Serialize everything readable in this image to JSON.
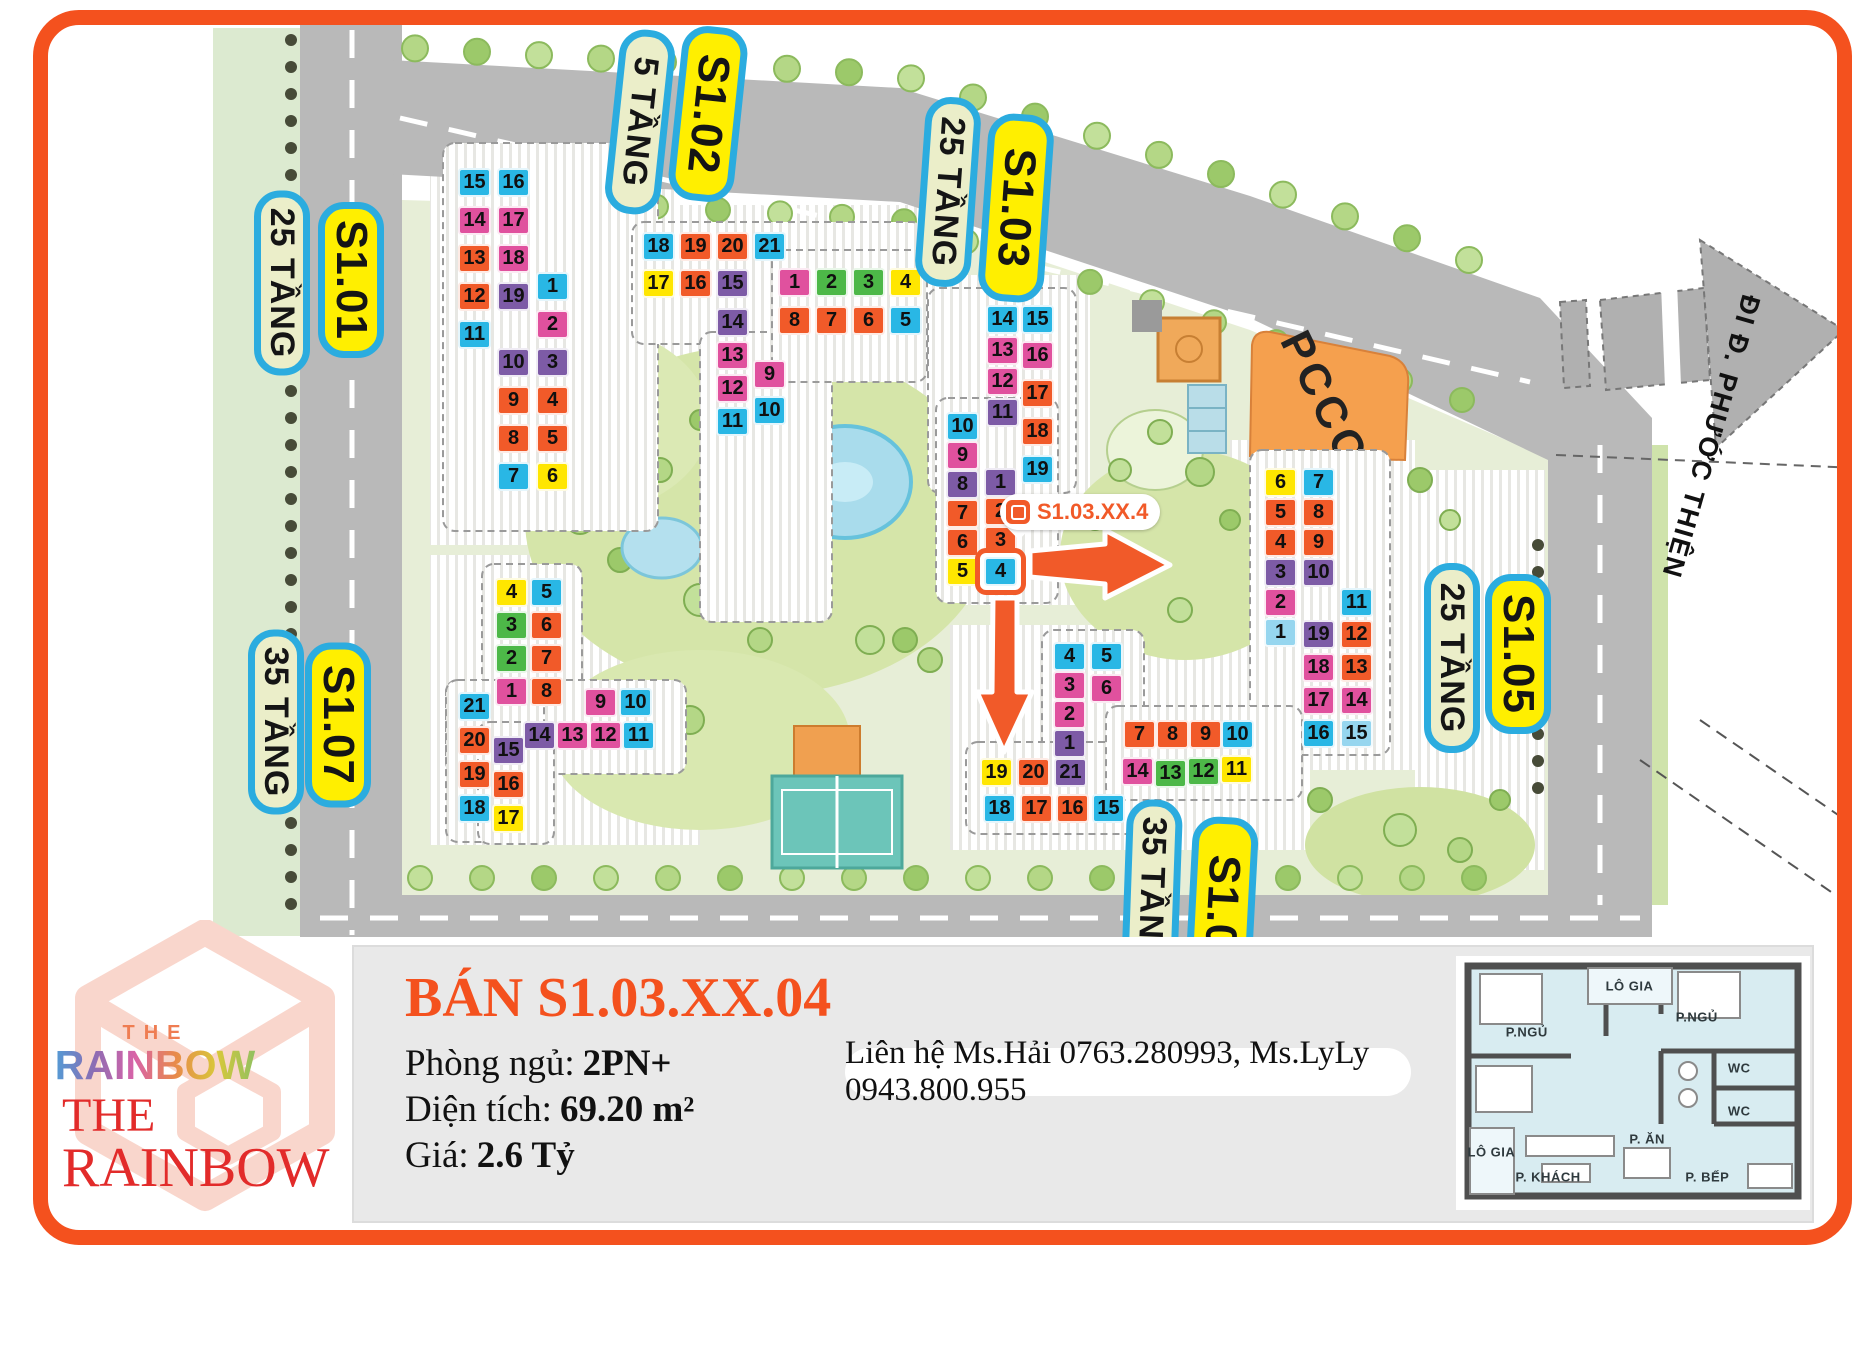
{
  "theme": {
    "accent": "#f4511e",
    "label_yellow": "#ffef00",
    "label_cream": "#ebeec9",
    "label_border": "#2bacdf"
  },
  "map": {
    "pccc_label": "PCCC",
    "exit_label": "ĐI Đ. PHƯỚC THIỆN",
    "marker": {
      "text": "S1.03.XX.4"
    },
    "unit_colors": {
      "cyan": "#29b7e5",
      "orange": "#f15a29",
      "pink": "#e0519e",
      "purple": "#7d5ba6",
      "yellow": "#ffe600",
      "green": "#4db848",
      "lightcyan": "#96d6ef"
    },
    "labels": [
      {
        "text": "25 TẦNG",
        "type": "floors",
        "cx": 282,
        "cy": 283,
        "w": 185,
        "h": 56,
        "rot": 90
      },
      {
        "text": "S1.01",
        "type": "block",
        "cx": 351,
        "cy": 280,
        "w": 156,
        "h": 66,
        "rot": 90
      },
      {
        "text": "35 TẦNG",
        "type": "floors",
        "cx": 276,
        "cy": 722,
        "w": 185,
        "h": 56,
        "rot": 90
      },
      {
        "text": "S1.07",
        "type": "block",
        "cx": 338,
        "cy": 725,
        "w": 165,
        "h": 66,
        "rot": 90
      },
      {
        "text": "5 TẦNG",
        "type": "floors",
        "cx": 640,
        "cy": 122,
        "w": 185,
        "h": 56,
        "rot": 96
      },
      {
        "text": "S1.02",
        "type": "block",
        "cx": 708,
        "cy": 114,
        "w": 175,
        "h": 66,
        "rot": 96
      },
      {
        "text": "25 TẦNG",
        "type": "floors",
        "cx": 948,
        "cy": 192,
        "w": 190,
        "h": 56,
        "rot": 94
      },
      {
        "text": "S1.03",
        "type": "block",
        "cx": 1016,
        "cy": 208,
        "w": 188,
        "h": 66,
        "rot": 94
      },
      {
        "text": "25 TẦNG",
        "type": "floors",
        "cx": 1452,
        "cy": 658,
        "w": 190,
        "h": 56,
        "rot": 90
      },
      {
        "text": "S1.05",
        "type": "block",
        "cx": 1518,
        "cy": 654,
        "w": 160,
        "h": 66,
        "rot": 90
      },
      {
        "text": "35 TẦNG",
        "type": "floors",
        "cx": 1152,
        "cy": 892,
        "w": 185,
        "h": 56,
        "rot": 92
      },
      {
        "text": "S1.0",
        "type": "block",
        "cx": 1222,
        "cy": 902,
        "w": 170,
        "h": 66,
        "rot": 93
      }
    ],
    "buildings": [
      {
        "name": "S1.01",
        "units": [
          [
            15,
            458,
            168,
            "cyan"
          ],
          [
            16,
            497,
            168,
            "cyan"
          ],
          [
            14,
            458,
            206,
            "pink"
          ],
          [
            17,
            497,
            206,
            "pink"
          ],
          [
            13,
            458,
            244,
            "orange"
          ],
          [
            18,
            497,
            244,
            "pink"
          ],
          [
            12,
            458,
            282,
            "orange"
          ],
          [
            19,
            497,
            282,
            "purple"
          ],
          [
            11,
            458,
            320,
            "cyan"
          ],
          [
            1,
            536,
            272,
            "cyan"
          ],
          [
            2,
            536,
            310,
            "pink"
          ],
          [
            10,
            497,
            348,
            "purple"
          ],
          [
            3,
            536,
            348,
            "purple"
          ],
          [
            9,
            497,
            386,
            "orange"
          ],
          [
            4,
            536,
            386,
            "orange"
          ],
          [
            8,
            497,
            424,
            "orange"
          ],
          [
            5,
            536,
            424,
            "orange"
          ],
          [
            7,
            497,
            462,
            "cyan"
          ],
          [
            6,
            536,
            462,
            "yellow"
          ]
        ]
      },
      {
        "name": "S1.02",
        "units": [
          [
            18,
            642,
            232,
            "cyan"
          ],
          [
            19,
            679,
            232,
            "orange"
          ],
          [
            20,
            716,
            232,
            "orange"
          ],
          [
            21,
            753,
            232,
            "cyan"
          ],
          [
            17,
            642,
            269,
            "yellow"
          ],
          [
            16,
            679,
            269,
            "orange"
          ],
          [
            15,
            716,
            269,
            "purple"
          ],
          [
            14,
            716,
            308,
            "purple"
          ],
          [
            13,
            716,
            341,
            "pink"
          ],
          [
            12,
            716,
            374,
            "pink"
          ],
          [
            11,
            716,
            407,
            "cyan"
          ],
          [
            9,
            753,
            360,
            "pink"
          ],
          [
            10,
            753,
            396,
            "cyan"
          ],
          [
            1,
            778,
            268,
            "pink"
          ],
          [
            2,
            815,
            268,
            "green"
          ],
          [
            3,
            852,
            268,
            "green"
          ],
          [
            4,
            889,
            268,
            "yellow"
          ],
          [
            8,
            778,
            306,
            "orange"
          ],
          [
            7,
            815,
            306,
            "orange"
          ],
          [
            6,
            852,
            306,
            "orange"
          ],
          [
            5,
            889,
            306,
            "cyan"
          ]
        ]
      },
      {
        "name": "S1.03",
        "highlight_unit": 4,
        "units": [
          [
            14,
            986,
            305,
            "cyan"
          ],
          [
            15,
            1021,
            305,
            "cyan"
          ],
          [
            13,
            986,
            336,
            "pink"
          ],
          [
            16,
            1021,
            341,
            "pink"
          ],
          [
            12,
            986,
            367,
            "pink"
          ],
          [
            17,
            1021,
            379,
            "orange"
          ],
          [
            11,
            986,
            398,
            "purple"
          ],
          [
            18,
            1021,
            417,
            "orange"
          ],
          [
            19,
            1021,
            455,
            "cyan"
          ],
          [
            10,
            946,
            412,
            "cyan"
          ],
          [
            9,
            946,
            441,
            "pink"
          ],
          [
            8,
            946,
            470,
            "purple"
          ],
          [
            7,
            946,
            499,
            "orange"
          ],
          [
            6,
            946,
            528,
            "orange"
          ],
          [
            5,
            946,
            557,
            "yellow"
          ],
          [
            1,
            984,
            468,
            "purple"
          ],
          [
            2,
            984,
            497,
            "orange"
          ],
          [
            3,
            984,
            526,
            "orange"
          ],
          [
            4,
            984,
            557,
            "cyan"
          ]
        ]
      },
      {
        "name": "S1.05",
        "units": [
          [
            6,
            1264,
            468,
            "yellow"
          ],
          [
            7,
            1302,
            468,
            "cyan"
          ],
          [
            5,
            1264,
            498,
            "orange"
          ],
          [
            8,
            1302,
            498,
            "orange"
          ],
          [
            4,
            1264,
            528,
            "orange"
          ],
          [
            9,
            1302,
            528,
            "orange"
          ],
          [
            3,
            1264,
            558,
            "purple"
          ],
          [
            10,
            1302,
            558,
            "purple"
          ],
          [
            2,
            1264,
            588,
            "pink"
          ],
          [
            11,
            1340,
            588,
            "cyan"
          ],
          [
            1,
            1264,
            618,
            "lightcyan"
          ],
          [
            19,
            1302,
            620,
            "purple"
          ],
          [
            12,
            1340,
            620,
            "orange"
          ],
          [
            18,
            1302,
            653,
            "pink"
          ],
          [
            13,
            1340,
            653,
            "orange"
          ],
          [
            17,
            1302,
            686,
            "pink"
          ],
          [
            14,
            1340,
            686,
            "pink"
          ],
          [
            16,
            1302,
            719,
            "cyan"
          ],
          [
            15,
            1340,
            719,
            "lightcyan"
          ]
        ]
      },
      {
        "name": "S1.06",
        "units": [
          [
            4,
            1053,
            642,
            "cyan"
          ],
          [
            5,
            1090,
            642,
            "cyan"
          ],
          [
            3,
            1053,
            671,
            "pink"
          ],
          [
            6,
            1090,
            674,
            "pink"
          ],
          [
            2,
            1053,
            700,
            "pink"
          ],
          [
            1,
            1053,
            729,
            "purple"
          ],
          [
            19,
            980,
            758,
            "yellow"
          ],
          [
            20,
            1017,
            758,
            "orange"
          ],
          [
            21,
            1054,
            758,
            "purple"
          ],
          [
            18,
            983,
            794,
            "cyan"
          ],
          [
            17,
            1020,
            794,
            "orange"
          ],
          [
            16,
            1056,
            794,
            "orange"
          ],
          [
            15,
            1092,
            794,
            "cyan"
          ],
          [
            7,
            1123,
            720,
            "orange"
          ],
          [
            8,
            1156,
            720,
            "orange"
          ],
          [
            9,
            1189,
            720,
            "orange"
          ],
          [
            10,
            1221,
            720,
            "cyan"
          ],
          [
            14,
            1121,
            757,
            "pink"
          ],
          [
            13,
            1154,
            759,
            "green"
          ],
          [
            12,
            1187,
            757,
            "green"
          ],
          [
            11,
            1220,
            755,
            "yellow"
          ]
        ]
      },
      {
        "name": "S1.07",
        "units": [
          [
            4,
            495,
            578,
            "yellow"
          ],
          [
            5,
            530,
            578,
            "cyan"
          ],
          [
            3,
            495,
            611,
            "green"
          ],
          [
            6,
            530,
            611,
            "orange"
          ],
          [
            2,
            495,
            644,
            "green"
          ],
          [
            7,
            530,
            644,
            "orange"
          ],
          [
            1,
            495,
            677,
            "pink"
          ],
          [
            8,
            530,
            677,
            "orange"
          ],
          [
            9,
            584,
            688,
            "pink"
          ],
          [
            10,
            619,
            688,
            "cyan"
          ],
          [
            14,
            523,
            721,
            "purple"
          ],
          [
            13,
            556,
            721,
            "pink"
          ],
          [
            12,
            589,
            721,
            "pink"
          ],
          [
            11,
            622,
            721,
            "cyan"
          ],
          [
            21,
            458,
            692,
            "cyan"
          ],
          [
            20,
            458,
            726,
            "orange"
          ],
          [
            19,
            458,
            760,
            "orange"
          ],
          [
            18,
            458,
            794,
            "cyan"
          ],
          [
            15,
            492,
            736,
            "purple"
          ],
          [
            16,
            492,
            770,
            "orange"
          ],
          [
            17,
            492,
            804,
            "yellow"
          ]
        ]
      }
    ]
  },
  "panel": {
    "title": "BÁN S1.03.XX.04",
    "rows": [
      {
        "label": "Phòng ngủ:",
        "value": "2PN+"
      },
      {
        "label": "Diện tích:",
        "value": "69.20 m²"
      },
      {
        "label": "Giá:",
        "value": "2.6 Tỷ"
      }
    ],
    "contact": "Liên hệ Ms.Hải 0763.280993, Ms.LyLy 0943.800.955"
  },
  "logo": {
    "the_small": "THE",
    "rainbow_gradient": "RAINBOW",
    "the_red": "THE",
    "rainbow_red": "RAINBOW"
  },
  "floorplan": {
    "rooms": [
      {
        "label": "LÔ GIA",
        "x": 49,
        "y": 12
      },
      {
        "label": "P.NGỦ",
        "x": 20,
        "y": 30
      },
      {
        "label": "P.NGỦ",
        "x": 68,
        "y": 24
      },
      {
        "label": "WC",
        "x": 80,
        "y": 44
      },
      {
        "label": "WC",
        "x": 80,
        "y": 61
      },
      {
        "label": "P. ĂN",
        "x": 54,
        "y": 72
      },
      {
        "label": "LÔ GIA",
        "x": 10,
        "y": 77
      },
      {
        "label": "P. KHÁCH",
        "x": 26,
        "y": 87
      },
      {
        "label": "P. BẾP",
        "x": 71,
        "y": 87
      }
    ]
  }
}
